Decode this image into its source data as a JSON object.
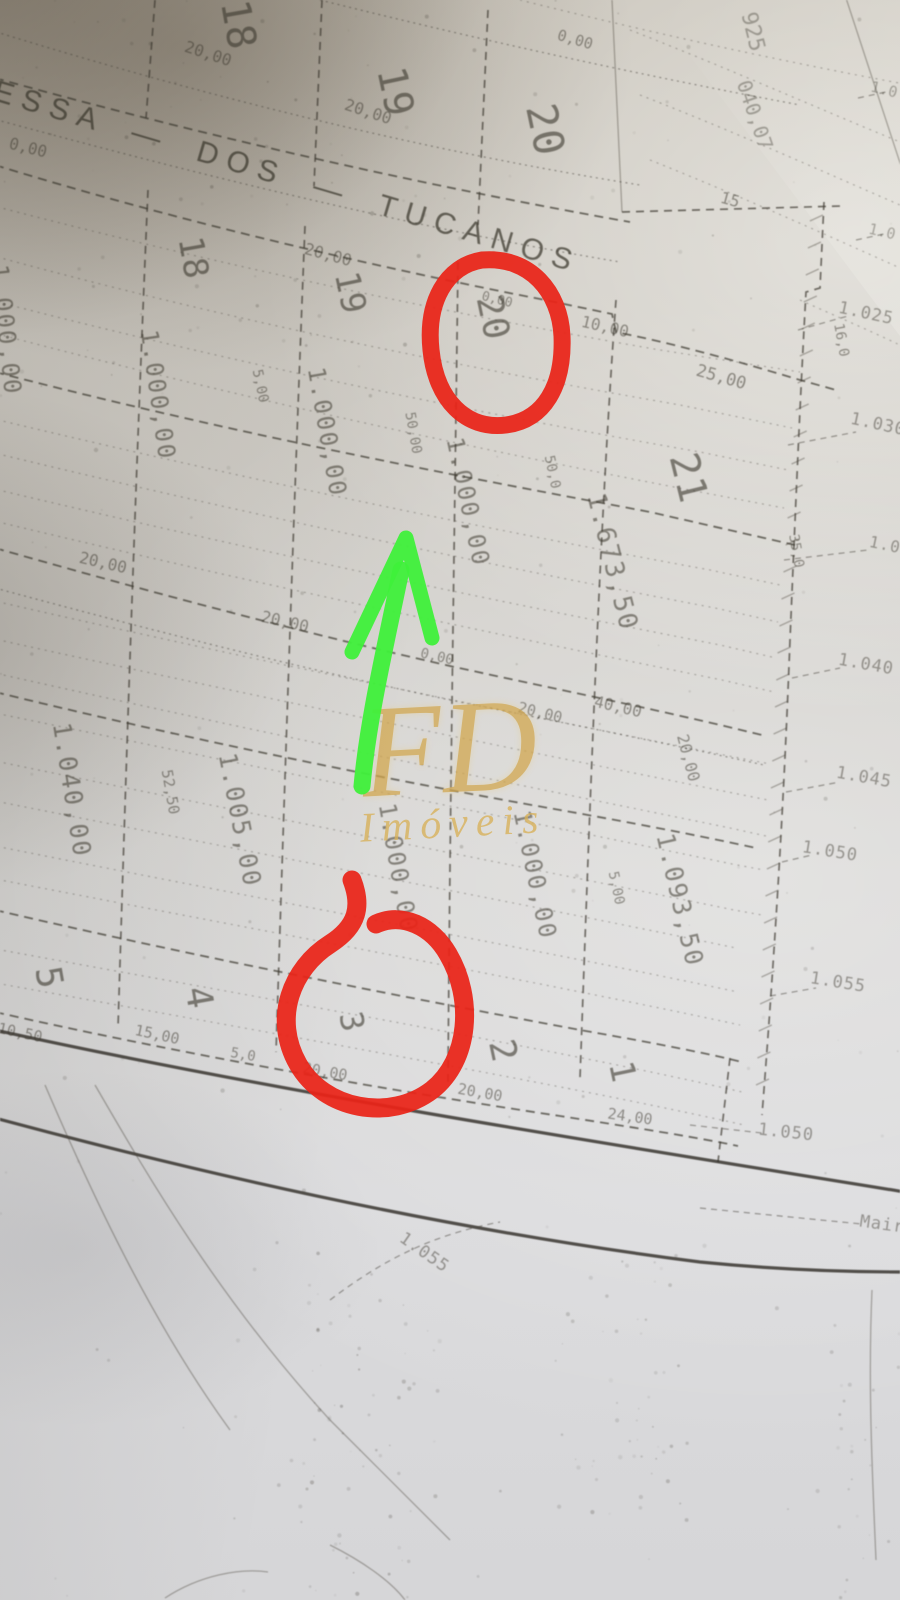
{
  "photo": {
    "street_label": "ESSA — DOS — TUCANOS",
    "watermark": {
      "initials": "FD",
      "name": "Imóveis",
      "color": "#d2a64b"
    },
    "annotations": {
      "circled_lot_top": "20",
      "circled_lot_bottom": "3",
      "circle_color": "#ea2418",
      "arrow_color": "#3ff03a"
    },
    "labels": {
      "lots": [
        {
          "t": "18",
          "x": 238,
          "y": 25,
          "r": 80,
          "s": 40
        },
        {
          "t": "19",
          "x": 395,
          "y": 92,
          "r": 78,
          "s": 40
        },
        {
          "t": "20",
          "x": 545,
          "y": 130,
          "r": 78,
          "s": 42
        },
        {
          "t": "18",
          "x": 193,
          "y": 258,
          "r": 80,
          "s": 34
        },
        {
          "t": "19",
          "x": 350,
          "y": 293,
          "r": 78,
          "s": 34
        },
        {
          "t": "20",
          "x": 492,
          "y": 318,
          "r": 78,
          "s": 36
        },
        {
          "t": "21",
          "x": 688,
          "y": 478,
          "r": 76,
          "s": 40
        },
        {
          "t": "5",
          "x": 48,
          "y": 978,
          "r": 80,
          "s": 36
        },
        {
          "t": "4",
          "x": 198,
          "y": 998,
          "r": 80,
          "s": 36
        },
        {
          "t": "3",
          "x": 352,
          "y": 1022,
          "r": 78,
          "s": 32
        },
        {
          "t": "2",
          "x": 502,
          "y": 1051,
          "r": 78,
          "s": 36
        },
        {
          "t": "1",
          "x": 622,
          "y": 1072,
          "r": 78,
          "s": 34
        }
      ],
      "areas": [
        {
          "t": "1.000,00",
          "x": 6,
          "y": 330,
          "r": 84,
          "s": 24
        },
        {
          "t": "1.000,00",
          "x": 158,
          "y": 395,
          "r": 82,
          "s": 24
        },
        {
          "t": "1.000,00",
          "x": 327,
          "y": 432,
          "r": 80,
          "s": 24
        },
        {
          "t": "1.000,00",
          "x": 468,
          "y": 502,
          "r": 78,
          "s": 24
        },
        {
          "t": "1.673,50",
          "x": 612,
          "y": 562,
          "r": 76,
          "s": 26
        },
        {
          "t": "1.040,00",
          "x": 72,
          "y": 790,
          "r": 81,
          "s": 25
        },
        {
          "t": "1.005,00",
          "x": 240,
          "y": 820,
          "r": 79,
          "s": 25
        },
        {
          "t": "1.000,00",
          "x": 398,
          "y": 868,
          "r": 80,
          "s": 24
        },
        {
          "t": "1.000,00",
          "x": 535,
          "y": 875,
          "r": 78,
          "s": 24
        },
        {
          "t": "1.093,50",
          "x": 680,
          "y": 900,
          "r": 77,
          "s": 25
        }
      ],
      "dimensions": [
        {
          "t": "0,00",
          "x": 28,
          "y": 148,
          "r": 14,
          "s": 16
        },
        {
          "t": "20,00",
          "x": 208,
          "y": 54,
          "r": 18,
          "s": 16
        },
        {
          "t": "20,00",
          "x": 368,
          "y": 112,
          "r": 18,
          "s": 16
        },
        {
          "t": "0,00",
          "x": 575,
          "y": 40,
          "r": 16,
          "s": 15
        },
        {
          "t": "20,00",
          "x": 328,
          "y": 255,
          "r": 15,
          "s": 16
        },
        {
          "t": "0,00",
          "x": 497,
          "y": 300,
          "r": 14,
          "s": 13
        },
        {
          "t": "10,00",
          "x": 605,
          "y": 327,
          "r": 13,
          "s": 16
        },
        {
          "t": "25,00",
          "x": 721,
          "y": 378,
          "r": 16,
          "s": 17
        },
        {
          "t": "20,00",
          "x": 103,
          "y": 563,
          "r": 13,
          "s": 16
        },
        {
          "t": "20,00",
          "x": 285,
          "y": 622,
          "r": 13,
          "s": 16
        },
        {
          "t": "0,00",
          "x": 437,
          "y": 657,
          "r": 13,
          "s": 14
        },
        {
          "t": "20,00",
          "x": 540,
          "y": 713,
          "r": 14,
          "s": 15
        },
        {
          "t": "40,00",
          "x": 618,
          "y": 707,
          "r": 13,
          "s": 16
        },
        {
          "t": "10,50",
          "x": 20,
          "y": 1033,
          "r": 12,
          "s": 15
        },
        {
          "t": "15,00",
          "x": 157,
          "y": 1035,
          "r": 12,
          "s": 15
        },
        {
          "t": "5,0",
          "x": 243,
          "y": 1055,
          "r": 10,
          "s": 14
        },
        {
          "t": "20,00",
          "x": 325,
          "y": 1072,
          "r": 10,
          "s": 15
        },
        {
          "t": "20,00",
          "x": 480,
          "y": 1093,
          "r": 10,
          "s": 15
        },
        {
          "t": "24,00",
          "x": 630,
          "y": 1117,
          "r": 8,
          "s": 15
        },
        {
          "t": "15",
          "x": 730,
          "y": 200,
          "r": 15,
          "s": 16
        },
        {
          "t": "5,00",
          "x": 260,
          "y": 386,
          "r": 78,
          "s": 14
        },
        {
          "t": "50,00",
          "x": 413,
          "y": 433,
          "r": 80,
          "s": 14
        },
        {
          "t": "50,0",
          "x": 552,
          "y": 472,
          "r": 78,
          "s": 14
        },
        {
          "t": "52,50",
          "x": 170,
          "y": 792,
          "r": 80,
          "s": 15
        },
        {
          "t": "5,00",
          "x": 616,
          "y": 888,
          "r": 78,
          "s": 14
        },
        {
          "t": "20,00",
          "x": 688,
          "y": 758,
          "r": 75,
          "s": 16
        },
        {
          "t": "35,0",
          "x": 796,
          "y": 551,
          "r": 80,
          "s": 14
        },
        {
          "t": "16,0",
          "x": 841,
          "y": 340,
          "r": 80,
          "s": 14
        }
      ],
      "contours": [
        {
          "t": "1.025",
          "x": 866,
          "y": 314,
          "r": 12,
          "s": 17
        },
        {
          "t": "1.030",
          "x": 878,
          "y": 425,
          "r": 12,
          "s": 17
        },
        {
          "t": "1.0",
          "x": 885,
          "y": 545,
          "r": 12,
          "s": 16
        },
        {
          "t": "1.040",
          "x": 866,
          "y": 665,
          "r": 10,
          "s": 17
        },
        {
          "t": "1.045",
          "x": 864,
          "y": 778,
          "r": 10,
          "s": 17
        },
        {
          "t": "1.050",
          "x": 830,
          "y": 852,
          "r": 9,
          "s": 17
        },
        {
          "t": "1.055",
          "x": 838,
          "y": 983,
          "r": 9,
          "s": 17
        },
        {
          "t": "1.050",
          "x": 786,
          "y": 1133,
          "r": 6,
          "s": 17
        },
        {
          "t": "1.055",
          "x": 424,
          "y": 1253,
          "r": 35,
          "s": 17
        },
        {
          "t": "Mair",
          "x": 882,
          "y": 1225,
          "r": 8,
          "s": 17
        }
      ],
      "fragments": [
        {
          "t": "925",
          "x": 752,
          "y": 32,
          "r": 76,
          "s": 22
        },
        {
          "t": "040,07",
          "x": 755,
          "y": 115,
          "r": 71,
          "s": 20
        },
        {
          "t": "1.0",
          "x": 884,
          "y": 90,
          "r": 14,
          "s": 15
        },
        {
          "t": "1.0",
          "x": 882,
          "y": 232,
          "r": 13,
          "s": 15
        }
      ]
    }
  }
}
